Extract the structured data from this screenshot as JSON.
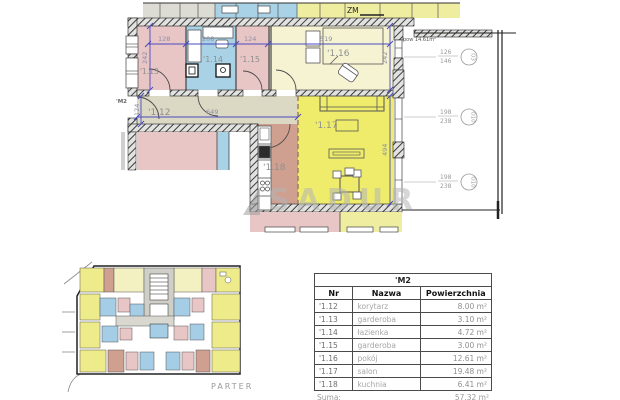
{
  "watermark": {
    "text": "SADUR"
  },
  "plan": {
    "unit_label": "'M2",
    "zm_label": "ZM",
    "balcony_area_label": "pow 14.61m²",
    "room_labels": {
      "r12": "'1.12",
      "r13": "'1.13",
      "r14": "'1.14",
      "r15": "'1.15",
      "r16": "'1.16",
      "r17": "'1.17",
      "r18": "'1.18"
    },
    "dims": {
      "w13": "128",
      "w14": "208",
      "w15": "124",
      "w16": "519",
      "h_band_left": "242",
      "h_band_right": "242",
      "h_corridor": "124",
      "w_corridor": "649",
      "h_salon": "494"
    },
    "windows": [
      {
        "size_top": "126",
        "size_bottom": "146",
        "type": "O3"
      },
      {
        "size_top": "198",
        "size_bottom": "238",
        "type": "O10"
      },
      {
        "size_top": "198",
        "size_bottom": "238",
        "type": "O10"
      }
    ]
  },
  "overview": {
    "floor_label": "PARTER"
  },
  "table": {
    "title": "'M2",
    "columns": {
      "nr": "Nr",
      "name": "Nazwa",
      "area": "Powierzchnia"
    },
    "rows": [
      {
        "nr": "'1.12",
        "name": "korytarz",
        "area": "8.00 m²"
      },
      {
        "nr": "'1.13",
        "name": "garderoba",
        "area": "3.10 m²"
      },
      {
        "nr": "'1.14",
        "name": "łazienka",
        "area": "4.72 m²"
      },
      {
        "nr": "'1.15",
        "name": "garderoba",
        "area": "3.00 m²"
      },
      {
        "nr": "'1.16",
        "name": "pokój",
        "area": "12.61 m²"
      },
      {
        "nr": "'1.17",
        "name": "salon",
        "area": "19.48 m²"
      },
      {
        "nr": "'1.18",
        "name": "kuchnia",
        "area": "6.41 m²"
      }
    ],
    "sum_label": "Suma:",
    "sum_value": "57.32 m²"
  },
  "colors": {
    "room_pink": "#e9c6c6",
    "room_blue": "#a9d2e6",
    "room_cream": "#f6f3d3",
    "room_yellow": "#eeec6a",
    "room_beige": "#dbd8c4",
    "room_brown": "#cfa090",
    "dim_blue": "#4a4ac0",
    "wall_hatch_bg": "#e2e2e0"
  }
}
